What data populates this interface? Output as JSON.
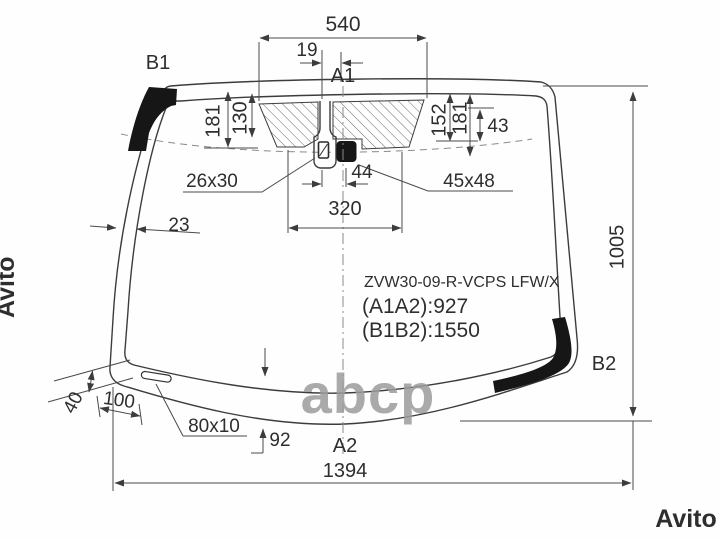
{
  "diagram": {
    "part": {
      "code": "ZVW30-09-R-VCPS LFW/X",
      "a1a2": "(A1A2):927",
      "b1b2": "(B1B2):1550"
    },
    "corner_labels": {
      "b1": "B1",
      "a1": "A1",
      "b2": "B2",
      "a2": "A2"
    },
    "dims": {
      "top_width": "540",
      "mirror_offset": "19",
      "left_outer_height": "181",
      "left_inner_height": "130",
      "right_inner_height": "152",
      "right_outer_height": "181",
      "right_corner": "43",
      "mirror_mount": "26x30",
      "mount_camera_gap": "44",
      "camera": "45x48",
      "center_span": "320",
      "side_band_width": "23",
      "glass_height": "1005",
      "corner_band_width": "40",
      "corner_offset": "100",
      "slot": "80x10",
      "bottom_band_height": "92",
      "bottom_width": "1394"
    },
    "colors": {
      "line": "#3c3c3c",
      "black_fill": "#161616",
      "watermark_center": "#9c9c9c",
      "watermark_edge": "#e9e9e9"
    }
  },
  "watermarks": {
    "center": "abcp",
    "left": "Avito",
    "right": "Avito"
  }
}
